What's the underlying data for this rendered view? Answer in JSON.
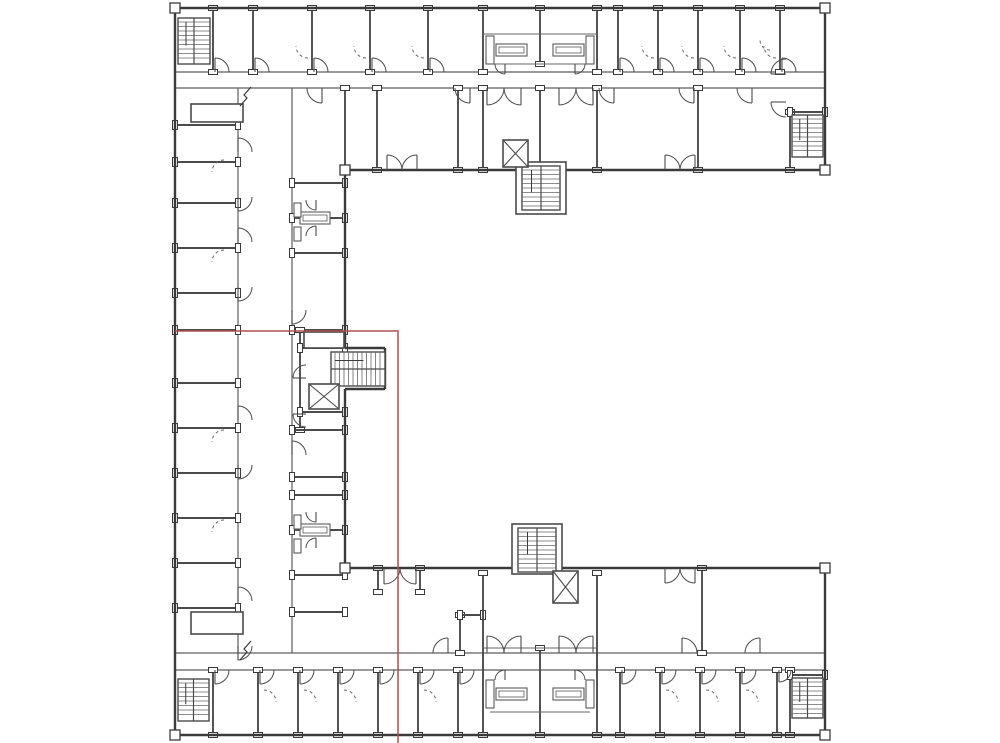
{
  "drawing": {
    "kind": "architectural-floor-plan",
    "canvas": {
      "width": 1000,
      "height": 743
    },
    "colors": {
      "background": "#ffffff",
      "outer_wall": "#3a3a3a",
      "partition": "#4b4b4b",
      "corridor": "#5e5e5e",
      "thin": "#666666",
      "fixture": "#5a5a5a",
      "selection": "#b04e4e"
    },
    "outer_walls": [
      [
        175,
        8,
        825,
        8
      ],
      [
        825,
        8,
        825,
        170
      ],
      [
        825,
        170,
        345,
        170
      ],
      [
        345,
        170,
        345,
        348
      ],
      [
        345,
        348,
        385,
        348
      ],
      [
        385,
        348,
        385,
        389
      ],
      [
        385,
        389,
        345,
        389
      ],
      [
        345,
        389,
        345,
        568
      ],
      [
        345,
        568,
        825,
        568
      ],
      [
        825,
        568,
        825,
        735
      ],
      [
        825,
        735,
        175,
        735
      ],
      [
        175,
        735,
        175,
        8
      ]
    ],
    "corridor_walls": [
      [
        175,
        72,
        825,
        72
      ],
      [
        175,
        88,
        825,
        88
      ],
      [
        238,
        88,
        238,
        653
      ],
      [
        292,
        88,
        292,
        653
      ],
      [
        175,
        653,
        825,
        653
      ],
      [
        175,
        670,
        825,
        670
      ]
    ],
    "partition_walls": [
      [
        213,
        8,
        213,
        72
      ],
      [
        253,
        8,
        253,
        72
      ],
      [
        312,
        8,
        312,
        72
      ],
      [
        370,
        8,
        370,
        72
      ],
      [
        428,
        8,
        428,
        72
      ],
      [
        483,
        8,
        483,
        72
      ],
      [
        540,
        8,
        540,
        64
      ],
      [
        597,
        8,
        597,
        72
      ],
      [
        618,
        8,
        618,
        72
      ],
      [
        658,
        8,
        658,
        72
      ],
      [
        698,
        8,
        698,
        72
      ],
      [
        740,
        8,
        740,
        72
      ],
      [
        780,
        8,
        780,
        72
      ],
      [
        483,
        88,
        483,
        170
      ],
      [
        540,
        88,
        540,
        170
      ],
      [
        597,
        88,
        597,
        170
      ],
      [
        345,
        88,
        345,
        170
      ],
      [
        377,
        88,
        377,
        170
      ],
      [
        458,
        88,
        458,
        170
      ],
      [
        698,
        88,
        698,
        170
      ],
      [
        790,
        112,
        790,
        170
      ],
      [
        790,
        112,
        825,
        112
      ],
      [
        175,
        125,
        238,
        125
      ],
      [
        175,
        162,
        238,
        162
      ],
      [
        175,
        203,
        238,
        203
      ],
      [
        175,
        248,
        238,
        248
      ],
      [
        175,
        293,
        238,
        293
      ],
      [
        175,
        330,
        238,
        330
      ],
      [
        175,
        383,
        238,
        383
      ],
      [
        175,
        428,
        238,
        428
      ],
      [
        175,
        473,
        238,
        473
      ],
      [
        175,
        518,
        238,
        518
      ],
      [
        175,
        563,
        238,
        563
      ],
      [
        175,
        608,
        238,
        608
      ],
      [
        292,
        183,
        345,
        183
      ],
      [
        292,
        218,
        345,
        218
      ],
      [
        292,
        253,
        345,
        253
      ],
      [
        292,
        330,
        345,
        330
      ],
      [
        300,
        330,
        300,
        430
      ],
      [
        300,
        348,
        345,
        348
      ],
      [
        300,
        412,
        345,
        412
      ],
      [
        292,
        430,
        345,
        430
      ],
      [
        292,
        477,
        345,
        477
      ],
      [
        292,
        495,
        345,
        495
      ],
      [
        292,
        530,
        345,
        530
      ],
      [
        292,
        575,
        345,
        575
      ],
      [
        292,
        612,
        345,
        612
      ],
      [
        378,
        568,
        378,
        592
      ],
      [
        420,
        568,
        420,
        592
      ],
      [
        460,
        615,
        460,
        653
      ],
      [
        460,
        615,
        483,
        615
      ],
      [
        702,
        568,
        702,
        653
      ],
      [
        483,
        573,
        483,
        735
      ],
      [
        540,
        648,
        540,
        735
      ],
      [
        597,
        573,
        597,
        735
      ],
      [
        213,
        670,
        213,
        735
      ],
      [
        258,
        670,
        258,
        735
      ],
      [
        298,
        670,
        298,
        735
      ],
      [
        338,
        670,
        338,
        735
      ],
      [
        378,
        670,
        378,
        735
      ],
      [
        418,
        670,
        418,
        735
      ],
      [
        458,
        670,
        458,
        735
      ],
      [
        620,
        670,
        620,
        735
      ],
      [
        660,
        670,
        660,
        735
      ],
      [
        700,
        670,
        700,
        735
      ],
      [
        740,
        670,
        740,
        735
      ],
      [
        777,
        670,
        777,
        735
      ],
      [
        790,
        670,
        790,
        735
      ],
      [
        790,
        675,
        825,
        675
      ]
    ],
    "thin_lines": [
      [
        483,
        34,
        597,
        34
      ],
      [
        490,
        64,
        590,
        64
      ],
      [
        483,
        648,
        597,
        648
      ],
      [
        490,
        712,
        590,
        712
      ]
    ],
    "enclosures": [
      {
        "x": 516,
        "y": 162,
        "w": 50,
        "h": 52
      },
      {
        "x": 512,
        "y": 524,
        "w": 50,
        "h": 50
      },
      {
        "x": 191,
        "y": 104,
        "w": 52,
        "h": 18
      },
      {
        "x": 191,
        "y": 612,
        "w": 52,
        "h": 22
      },
      {
        "x": 304,
        "y": 332,
        "w": 40,
        "h": 16
      }
    ],
    "fixtures": [
      {
        "x": 496,
        "y": 44,
        "w": 31,
        "h": 12,
        "kind": "counter"
      },
      {
        "x": 553,
        "y": 44,
        "w": 31,
        "h": 12,
        "kind": "counter"
      },
      {
        "x": 486,
        "y": 36,
        "w": 8,
        "h": 28,
        "kind": "unit"
      },
      {
        "x": 586,
        "y": 36,
        "w": 8,
        "h": 28,
        "kind": "unit"
      },
      {
        "x": 496,
        "y": 688,
        "w": 31,
        "h": 12,
        "kind": "counter"
      },
      {
        "x": 553,
        "y": 688,
        "w": 31,
        "h": 12,
        "kind": "counter"
      },
      {
        "x": 486,
        "y": 680,
        "w": 8,
        "h": 28,
        "kind": "unit"
      },
      {
        "x": 586,
        "y": 680,
        "w": 8,
        "h": 28,
        "kind": "unit"
      },
      {
        "x": 300,
        "y": 212,
        "w": 30,
        "h": 12,
        "kind": "counter"
      },
      {
        "x": 294,
        "y": 203,
        "w": 7,
        "h": 14,
        "kind": "unit"
      },
      {
        "x": 294,
        "y": 227,
        "w": 7,
        "h": 14,
        "kind": "unit"
      },
      {
        "x": 300,
        "y": 524,
        "w": 30,
        "h": 12,
        "kind": "counter"
      },
      {
        "x": 294,
        "y": 515,
        "w": 7,
        "h": 14,
        "kind": "unit"
      },
      {
        "x": 294,
        "y": 539,
        "w": 7,
        "h": 14,
        "kind": "unit"
      }
    ],
    "stairs": [
      {
        "x": 178,
        "y": 18,
        "w": 32,
        "h": 46,
        "dir": "v"
      },
      {
        "x": 792,
        "y": 115,
        "w": 31,
        "h": 42,
        "dir": "v"
      },
      {
        "x": 522,
        "y": 166,
        "w": 38,
        "h": 44,
        "dir": "v"
      },
      {
        "x": 331,
        "y": 352,
        "w": 54,
        "h": 34,
        "dir": "h"
      },
      {
        "x": 518,
        "y": 528,
        "w": 38,
        "h": 44,
        "dir": "v"
      },
      {
        "x": 178,
        "y": 679,
        "w": 31,
        "h": 42,
        "dir": "v"
      },
      {
        "x": 792,
        "y": 678,
        "w": 31,
        "h": 40,
        "dir": "v"
      }
    ],
    "elevators": [
      {
        "x": 503,
        "y": 140,
        "w": 25,
        "h": 27
      },
      {
        "x": 309,
        "y": 384,
        "w": 30,
        "h": 25
      },
      {
        "x": 553,
        "y": 571,
        "w": 25,
        "h": 32
      }
    ],
    "doors": [
      [
        215,
        72,
        14,
        270,
        360
      ],
      [
        255,
        72,
        14,
        270,
        360
      ],
      [
        314,
        72,
        14,
        270,
        360
      ],
      [
        372,
        72,
        14,
        270,
        360
      ],
      [
        430,
        72,
        14,
        270,
        360
      ],
      [
        620,
        72,
        14,
        270,
        360
      ],
      [
        660,
        72,
        14,
        270,
        360
      ],
      [
        700,
        72,
        14,
        270,
        360
      ],
      [
        742,
        72,
        14,
        270,
        360
      ],
      [
        782,
        72,
        14,
        270,
        360
      ],
      [
        215,
        670,
        14,
        90,
        0
      ],
      [
        260,
        670,
        14,
        90,
        0
      ],
      [
        300,
        670,
        14,
        90,
        0
      ],
      [
        340,
        670,
        14,
        90,
        0
      ],
      [
        380,
        670,
        14,
        90,
        0
      ],
      [
        420,
        670,
        14,
        90,
        0
      ],
      [
        460,
        670,
        14,
        90,
        0
      ],
      [
        622,
        670,
        14,
        90,
        0
      ],
      [
        662,
        670,
        14,
        90,
        0
      ],
      [
        702,
        670,
        14,
        90,
        0
      ],
      [
        742,
        670,
        14,
        90,
        0
      ],
      [
        779,
        670,
        12,
        90,
        0
      ],
      [
        322,
        88,
        15,
        90,
        180
      ],
      [
        470,
        88,
        15,
        90,
        180
      ],
      [
        614,
        88,
        15,
        90,
        180
      ],
      [
        694,
        88,
        15,
        90,
        180
      ],
      [
        752,
        88,
        15,
        90,
        180
      ],
      [
        448,
        653,
        15,
        270,
        180
      ],
      [
        682,
        653,
        15,
        270,
        360
      ],
      [
        760,
        653,
        15,
        270,
        180
      ],
      [
        238,
        152,
        14,
        270,
        0
      ],
      [
        238,
        242,
        14,
        270,
        0
      ],
      [
        238,
        420,
        14,
        270,
        0
      ],
      [
        238,
        601,
        14,
        270,
        0
      ],
      [
        238,
        197,
        14,
        90,
        0
      ],
      [
        238,
        287,
        14,
        90,
        0
      ],
      [
        238,
        465,
        14,
        90,
        0
      ],
      [
        238,
        646,
        14,
        90,
        0
      ],
      [
        292,
        310,
        14,
        90,
        0
      ],
      [
        292,
        455,
        14,
        270,
        0
      ],
      [
        505,
        64,
        10,
        90,
        180
      ],
      [
        575,
        64,
        10,
        90,
        0
      ],
      [
        505,
        680,
        10,
        270,
        180
      ],
      [
        575,
        680,
        10,
        270,
        0
      ],
      [
        316,
        200,
        10,
        90,
        180
      ],
      [
        316,
        236,
        10,
        270,
        180
      ],
      [
        316,
        512,
        10,
        90,
        180
      ],
      [
        316,
        548,
        10,
        270,
        180
      ],
      [
        306,
        378,
        13,
        180,
        270
      ],
      [
        306,
        414,
        13,
        180,
        90
      ],
      [
        786,
        74,
        15,
        180,
        270
      ],
      [
        786,
        102,
        15,
        180,
        90
      ],
      [
        387,
        170,
        15,
        270,
        360
      ],
      [
        417,
        170,
        15,
        270,
        180
      ],
      [
        665,
        170,
        15,
        270,
        360
      ],
      [
        695,
        170,
        15,
        270,
        180
      ],
      [
        384,
        568,
        16,
        90,
        0
      ],
      [
        416,
        568,
        16,
        90,
        180
      ],
      [
        665,
        568,
        15,
        90,
        0
      ],
      [
        695,
        568,
        15,
        90,
        180
      ],
      [
        487,
        88,
        17,
        90,
        0
      ],
      [
        521,
        88,
        17,
        90,
        180
      ],
      [
        559,
        88,
        17,
        90,
        0
      ],
      [
        593,
        88,
        17,
        90,
        180
      ],
      [
        487,
        653,
        17,
        270,
        360
      ],
      [
        521,
        653,
        17,
        270,
        180
      ],
      [
        559,
        653,
        17,
        270,
        360
      ],
      [
        593,
        653,
        17,
        270,
        180
      ],
      [
        308,
        46,
        12,
        90,
        180,
        1
      ],
      [
        366,
        46,
        12,
        90,
        180,
        1
      ],
      [
        424,
        46,
        12,
        90,
        180,
        1
      ],
      [
        654,
        46,
        12,
        90,
        180,
        1
      ],
      [
        694,
        46,
        12,
        90,
        180,
        1
      ],
      [
        736,
        46,
        12,
        90,
        180,
        1
      ],
      [
        776,
        46,
        12,
        90,
        180,
        1
      ],
      [
        264,
        702,
        12,
        270,
        0,
        1
      ],
      [
        304,
        702,
        12,
        270,
        0,
        1
      ],
      [
        344,
        702,
        12,
        270,
        0,
        1
      ],
      [
        424,
        702,
        12,
        270,
        0,
        1
      ],
      [
        666,
        702,
        12,
        270,
        0,
        1
      ],
      [
        706,
        702,
        12,
        270,
        0,
        1
      ],
      [
        746,
        702,
        12,
        270,
        0,
        1
      ],
      [
        224,
        172,
        12,
        270,
        180,
        1
      ],
      [
        224,
        262,
        12,
        270,
        180,
        1
      ],
      [
        224,
        442,
        12,
        270,
        180,
        1
      ],
      [
        224,
        532,
        12,
        270,
        180,
        1
      ],
      [
        770,
        40,
        10,
        90,
        180,
        1
      ]
    ],
    "posts": [
      [
        175,
        8
      ],
      [
        825,
        8
      ],
      [
        825,
        170
      ],
      [
        825,
        568
      ],
      [
        825,
        735
      ],
      [
        175,
        735
      ],
      [
        345,
        170
      ],
      [
        345,
        568
      ]
    ],
    "break_marks": [
      [
        247,
        96
      ],
      [
        247,
        650
      ]
    ],
    "selection_overlay": {
      "x1": 175,
      "y1": 331,
      "x2": 398,
      "y2": 743,
      "visible_sides": [
        "top",
        "right"
      ]
    }
  }
}
